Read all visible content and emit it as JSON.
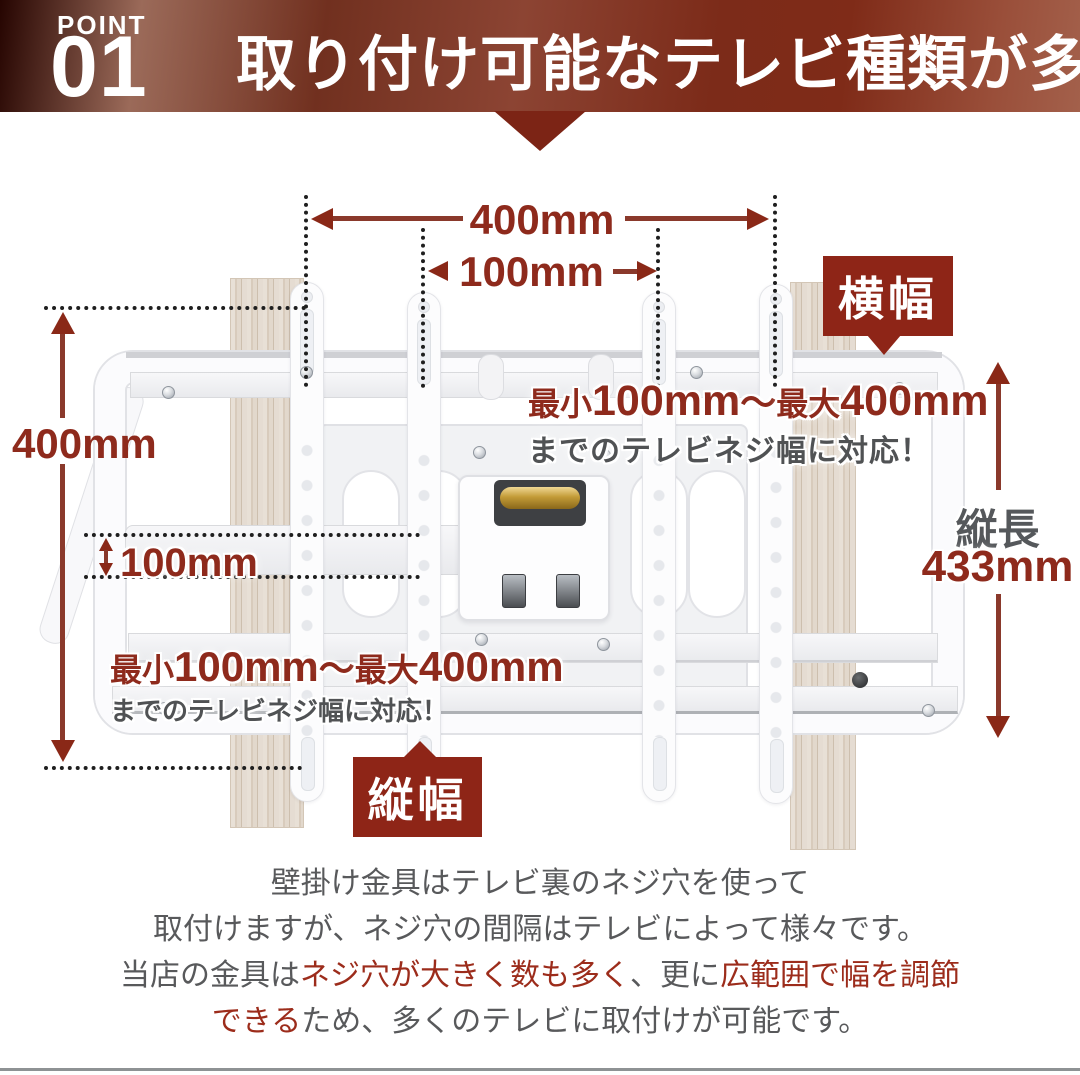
{
  "header": {
    "point_label": "POINT",
    "point_number": "01",
    "title": "取り付け可能なテレビ種類が多い"
  },
  "diagram": {
    "measure_top_outer": "400mm",
    "measure_top_inner": "100mm",
    "measure_left_outer": "400mm",
    "measure_left_inner": "100mm",
    "badge_width": "横幅",
    "badge_height": "縦幅",
    "side_label": "縦長",
    "side_value": "433mm",
    "callout": {
      "min_label": "最小",
      "min_value": "100mm",
      "separator": "～",
      "max_label": "最大",
      "max_value": "400mm",
      "caption": "までのテレビネジ幅に対応！"
    }
  },
  "description": {
    "line1": "壁掛け金具はテレビ裏のネジ穴を使って",
    "line2": "取付けますが、ネジ穴の間隔はテレビによって様々です。",
    "line3": {
      "a": "当店の金具は",
      "b": "ネジ穴が大きく数も多く",
      "c": "、更に",
      "d": "広範囲で幅を調節"
    },
    "line4": {
      "a": "できる",
      "b": "ため、多くのテレビに取付けが可能です。"
    }
  },
  "colors": {
    "accent_red": "#8e2a1c",
    "badge_red": "#8e2517",
    "text_gray": "#55585b",
    "body_red": "#9c2c1b"
  }
}
